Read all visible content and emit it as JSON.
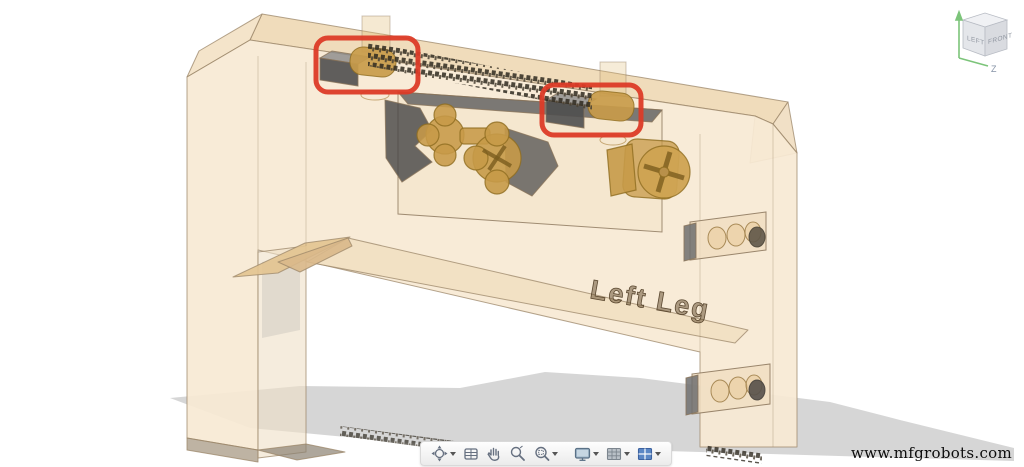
{
  "scene": {
    "background": "#ffffff",
    "shadow_color": "#cbcbcb",
    "model": {
      "label": "Left Leg",
      "body_color": "#f7e9d4",
      "top_color": "#efd9b5",
      "chamfer_color": "#f3e2c6",
      "edge_color": "#9b8668",
      "hardware_color": "#c89b4a",
      "slot_color": "#4f4f4f"
    },
    "highlights": {
      "color": "#dc3b27",
      "count": 2
    }
  },
  "viewcube": {
    "left_label": "LEFT",
    "front_label": "FRONT",
    "axis_label": "Z"
  },
  "toolbar": {
    "items": [
      {
        "name": "orbit",
        "has_dropdown": true
      },
      {
        "name": "look-at",
        "has_dropdown": false
      },
      {
        "name": "pan",
        "has_dropdown": false
      },
      {
        "name": "zoom",
        "has_dropdown": false
      },
      {
        "name": "fit",
        "has_dropdown": true
      },
      {
        "name": "display-settings",
        "has_dropdown": true
      },
      {
        "name": "grid-and-snaps",
        "has_dropdown": true
      },
      {
        "name": "viewports",
        "has_dropdown": true
      }
    ]
  },
  "watermark": {
    "text": "www.mfgrobots.com"
  }
}
